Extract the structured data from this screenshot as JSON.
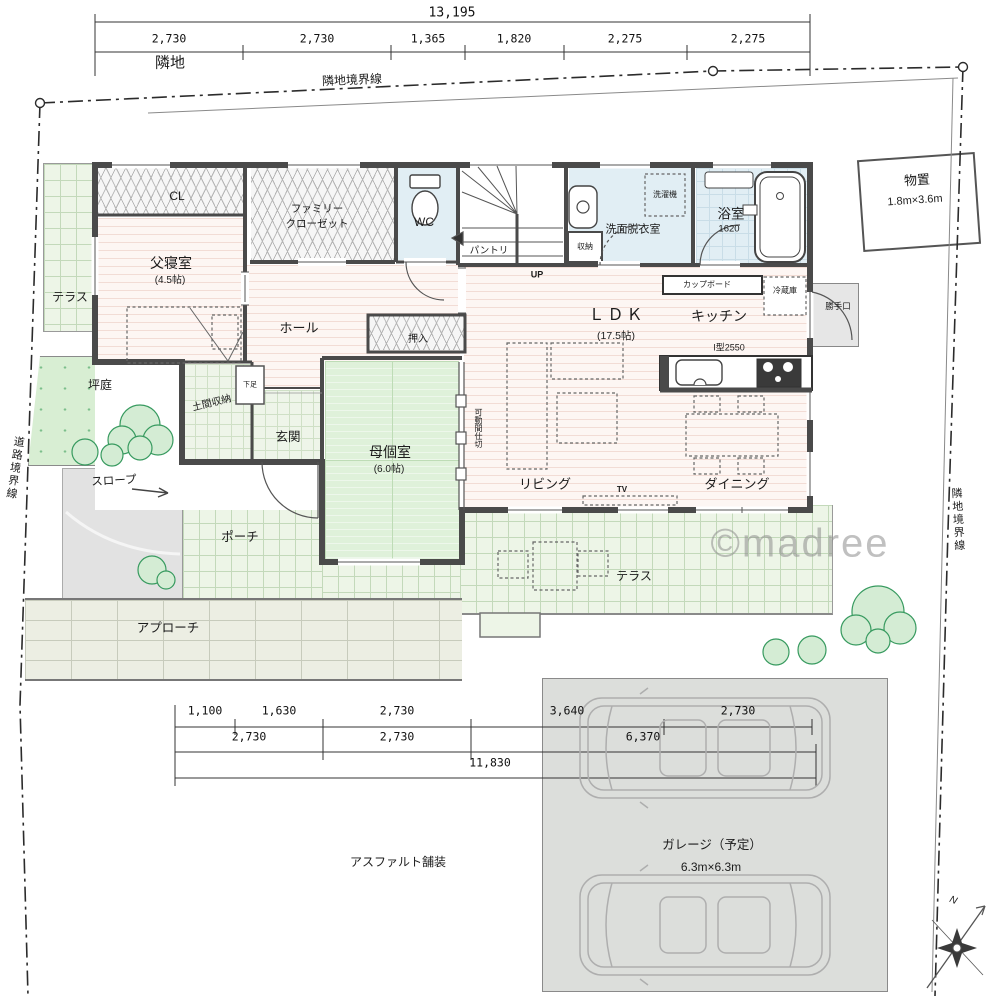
{
  "meta": {
    "watermark": "©madree"
  },
  "site": {
    "neighbor_label": "隣地",
    "boundary_top": "隣地境界線",
    "boundary_right": "隣地境界線",
    "boundary_road": "道路境界線",
    "asphalt": "アスファルト舗装",
    "compass_n": "N"
  },
  "dims_top": {
    "total": "13,195",
    "segments": [
      "2,730",
      "2,730",
      "1,365",
      "1,820",
      "2,275",
      "2,275"
    ]
  },
  "dims_bottom": {
    "row1": [
      "1,100",
      "1,630",
      "2,730",
      "3,640",
      "2,730"
    ],
    "row2": [
      "2,730",
      "2,730",
      "6,370"
    ],
    "row3": "11,830"
  },
  "rooms": {
    "cl": "CL",
    "family_closet_1": "ファミリー",
    "family_closet_2": "クローゼット",
    "wc": "WC",
    "pantry": "パントリ",
    "stairs_up": "UP",
    "washroom": "洗面脱衣室",
    "washer": "洗濯機",
    "shuno": "収納",
    "bath": "浴室",
    "bath_size": "1620",
    "monooki": "物置",
    "monooki_size": "1.8m×3.6m",
    "father_room": "父寝室",
    "father_size": "(4.5帖)",
    "hall": "ホール",
    "oshiire": "押入",
    "ldk": "ＬＤＫ",
    "ldk_size": "(17.5帖)",
    "kitchen": "キッチン",
    "kitchen_unit": "I型2550",
    "cupboard": "カップボード",
    "fridge": "冷蔵庫",
    "backdoor": "勝手口",
    "mother_room": "母個室",
    "mother_size": "(6.0帖)",
    "partition": "可動間仕切",
    "living": "リビング",
    "dining": "ダイニング",
    "tv": "TV",
    "genkan": "玄関",
    "doma": "土間収納",
    "geta": "下足",
    "terrace_left": "テラス",
    "terrace_main": "テラス",
    "tsuboniwa": "坪庭",
    "slope": "スロープ",
    "porch": "ポーチ",
    "approach": "アプローチ",
    "garage": "ガレージ（予定）",
    "garage_size": "6.3m×6.3m"
  }
}
